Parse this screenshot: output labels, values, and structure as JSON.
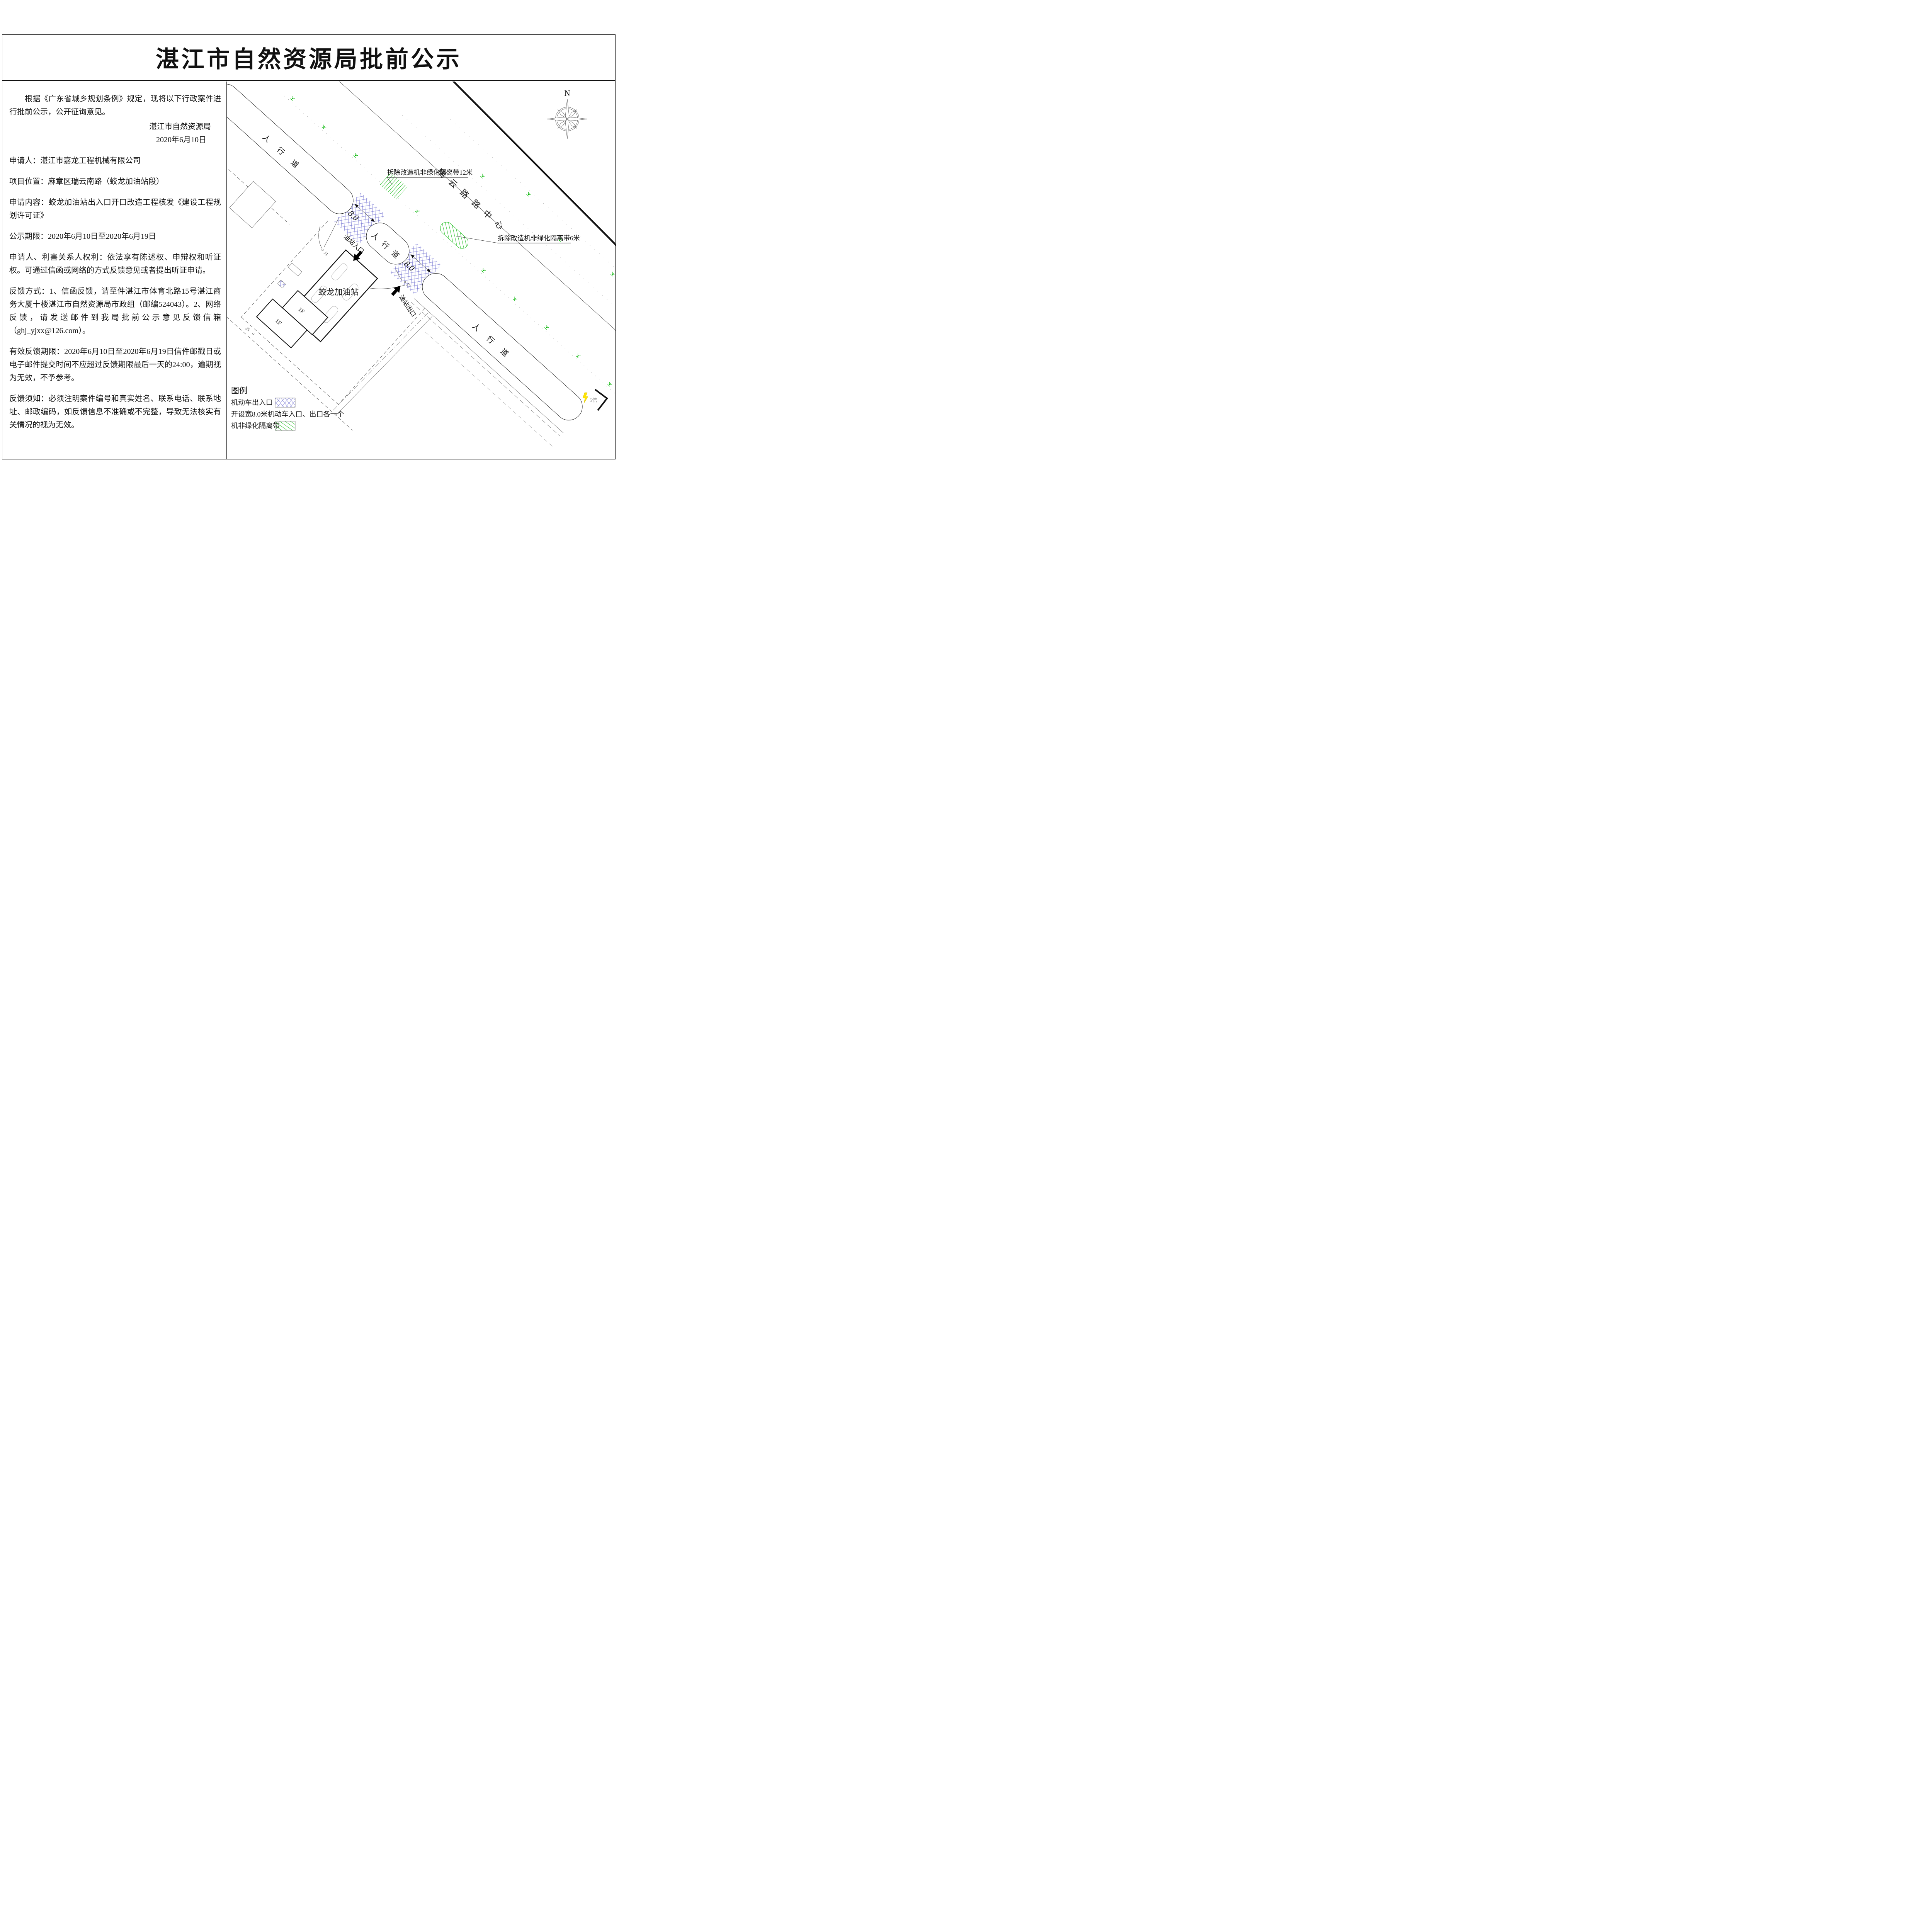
{
  "page": {
    "title": "湛江市自然资源局批前公示"
  },
  "notice": {
    "intro": "根据《广东省城乡规划条例》规定，现将以下行政案件进行批前公示，公开征询意见。",
    "agency": "湛江市自然资源局",
    "date": "2020年6月10日",
    "applicant": "申请人：湛江市嘉龙工程机械有限公司",
    "location": "项目位置：麻章区瑞云南路（蛟龙加油站段）",
    "request": "申请内容：蛟龙加油站出入口开口改造工程核发《建设工程规划许可证》",
    "period": "公示期限：2020年6月10日至2020年6月19日",
    "rights": "申请人、利害关系人权利：依法享有陈述权、申辩权和听证权。可通过信函或网络的方式反馈意见或者提出听证申请。",
    "feedback": "反馈方式：1、信函反馈，请至件湛江市体育北路15号湛江商务大厦十楼湛江市自然资源局市政组（邮编524043）。2、网络反馈，请发送邮件到我局批前公示意见反馈信箱（ghj_yjxx@126.com）。",
    "deadline": "有效反馈期限：2020年6月10日至2020年6月19日信件邮戳日或电子邮件提交时间不应超过反馈期限最后一天的24:00，逾期视为无效，不予参考。",
    "notes": "反馈须知：必须注明案件编号和真实姓名、联系电话、联系地址、邮政编码，如反馈信息不准确或不完整，导致无法核实有关情况的视为无效。"
  },
  "map": {
    "north": "N",
    "sidewalk": "人行道",
    "road_centerline": "瑞云路路中心",
    "demolish_12m": "拆除改造机非绿化隔离带12米",
    "demolish_6m": "拆除改造机非绿化隔离带6米",
    "crossing_width": "8.0",
    "station_entrance": "油站入口",
    "station_exit": "油站出口",
    "station_name": "蛟龙加油站",
    "floor": "1F",
    "j1": "J1",
    "j2": "J2",
    "j5": "J5",
    "corner_note": "5信"
  },
  "legend": {
    "title": "图例",
    "vehicle_access": "机动车出入口",
    "note": "开设宽8.0米机动车入口、出口各一个",
    "green_belt": "机非绿化隔离带"
  },
  "colors": {
    "crosshatch_blue": "#6a6ace",
    "greenbelt_green": "#00b400",
    "bolt_yellow": "#ffe400"
  }
}
